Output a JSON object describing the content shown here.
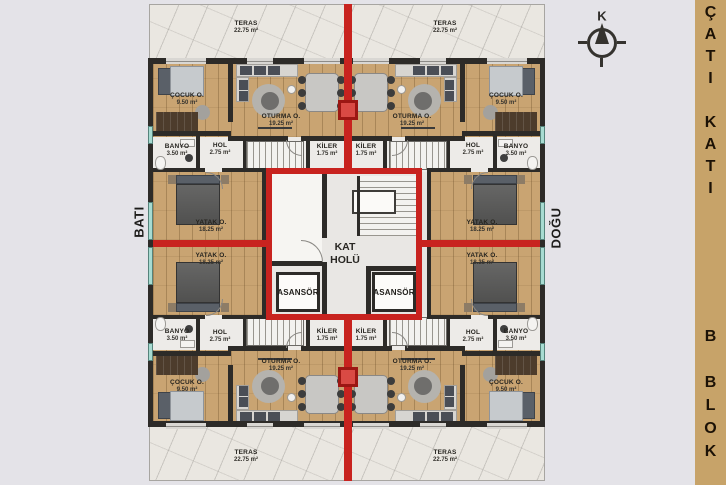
{
  "sidebar": {
    "floor_label": "ÇATI KATI",
    "block_label": "B BLOK"
  },
  "compass": {
    "north_label": "K"
  },
  "directions": {
    "west_label": "BATI",
    "east_label": "DOĞU"
  },
  "core": {
    "hall_label": "KAT HOLÜ",
    "elevators": [
      "ASANSÖR",
      "ASANSÖR"
    ]
  },
  "terraces": [
    {
      "name": "TERAS",
      "area": "22.75 m²"
    },
    {
      "name": "TERAS",
      "area": "22.75 m²"
    },
    {
      "name": "TERAS",
      "area": "22.75 m²"
    },
    {
      "name": "TERAS",
      "area": "22.75 m²"
    }
  ],
  "units": [
    {
      "position": "top-left",
      "rooms": [
        {
          "name": "ÇOCUK O.",
          "area": "9.50 m²"
        },
        {
          "name": "OTURMA O.",
          "area": "19.25 m²"
        },
        {
          "name": "BANYO",
          "area": "3.50 m²"
        },
        {
          "name": "HOL",
          "area": "2.75 m²"
        },
        {
          "name": "KİLER",
          "area": "1.75 m²"
        },
        {
          "name": "YATAK O.",
          "area": "18.25 m²"
        }
      ]
    },
    {
      "position": "top-right",
      "rooms": [
        {
          "name": "ÇOCUK O.",
          "area": "9.50 m²"
        },
        {
          "name": "OTURMA O.",
          "area": "19.25 m²"
        },
        {
          "name": "BANYO",
          "area": "3.50 m²"
        },
        {
          "name": "HOL",
          "area": "2.75 m²"
        },
        {
          "name": "KİLER",
          "area": "1.75 m²"
        },
        {
          "name": "YATAK O.",
          "area": "18.25 m²"
        }
      ]
    },
    {
      "position": "bottom-left",
      "rooms": [
        {
          "name": "ÇOCUK O.",
          "area": "9.50 m²"
        },
        {
          "name": "OTURMA O.",
          "area": "19.25 m²"
        },
        {
          "name": "BANYO",
          "area": "3.50 m²"
        },
        {
          "name": "HOL",
          "area": "2.75 m²"
        },
        {
          "name": "KİLER",
          "area": "1.75 m²"
        },
        {
          "name": "YATAK O.",
          "area": "18.25 m²"
        }
      ]
    },
    {
      "position": "bottom-right",
      "rooms": [
        {
          "name": "ÇOCUK O.",
          "area": "9.50 m²"
        },
        {
          "name": "OTURMA O.",
          "area": "19.25 m²"
        },
        {
          "name": "BANYO",
          "area": "3.50 m²"
        },
        {
          "name": "HOL",
          "area": "2.75 m²"
        },
        {
          "name": "KİLER",
          "area": "1.75 m²"
        },
        {
          "name": "YATAK O.",
          "area": "18.25 m²"
        }
      ]
    }
  ],
  "colors": {
    "accent_red": "#c8231f",
    "wall": "#2d2b28",
    "wood": "#c9a472",
    "window_teal": "#a7dbd1",
    "sidebar_tan": "#c7a369",
    "background": "#e4e3e8"
  }
}
